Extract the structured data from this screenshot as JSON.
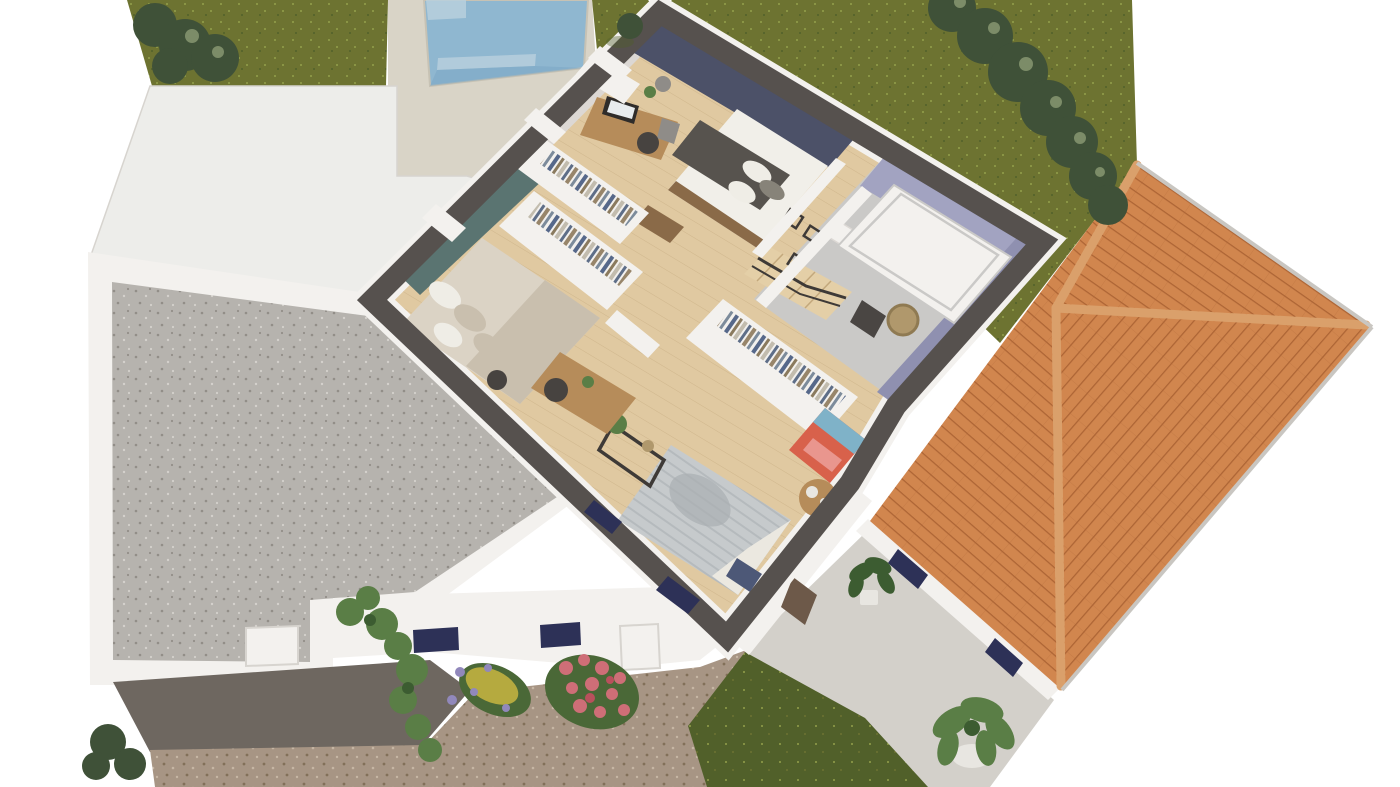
{
  "meta": {
    "view": "3d-floorplan-upper-floor-cutaway",
    "rooms": [
      {
        "name": "master-bedroom",
        "accent": "navy"
      },
      {
        "name": "walk-in-closet",
        "accent": "white"
      },
      {
        "name": "second-bedroom",
        "accent": "teal"
      },
      {
        "name": "third-bedroom",
        "accent": "white"
      },
      {
        "name": "bathroom",
        "accent": "lavender"
      },
      {
        "name": "hallway-stairs",
        "accent": "white"
      }
    ],
    "exterior": [
      "lawn",
      "hedges",
      "swimming-pool",
      "pool-deck",
      "terrace-slab",
      "gravel-courtyard",
      "carport",
      "gravel-driveway",
      "front-facade",
      "climbing-vine",
      "rose-bush",
      "flower-bed",
      "terracotta-roof",
      "patio",
      "potted-plants"
    ]
  },
  "colors": {
    "bg": "#ffffff",
    "grass": "#6d7331",
    "grass_dark": "#51602a",
    "grass_speck": "#93a04b",
    "tree": "#3f5138",
    "tree_light": "#7c8c68",
    "pool_water": "#8fb7d0",
    "pool_water_deep": "#79a6c4",
    "pool_step": "#b9d0dd",
    "deck": "#d9d4c7",
    "deck_line": "#c7c2b4",
    "slab": "#ededea",
    "slab_edge": "#d7d4cf",
    "cut_band": "#56514e",
    "wall_white": "#f3f1ee",
    "wall_shade": "#dcd8d4",
    "navy_wall": "#4c5168",
    "teal_wall": "#5a7471",
    "lavender": "#a2a3c1",
    "lavender_deep": "#8f90b0",
    "bath_floor": "#cac9c7",
    "wood": "#e0c9a1",
    "wood_line": "#c3a87c",
    "roof": "#d1864e",
    "roof_line": "#ad6535",
    "roof_ridge": "#daa06b",
    "gutter": "#c9c6c1",
    "gravel": "#b6b3ae",
    "gravel_dot": "#928e88",
    "gravel_light": "#d4d1cc",
    "driveway": "#a79584",
    "driveway_dot": "#827059",
    "driveway_light": "#c6b6a4",
    "shadow": "#6e6760",
    "terrace": "#d3d0ca",
    "shutter": "#2d3157",
    "passage_door": "#6d5949",
    "duvet": "#57534e",
    "mattress": "#f1efe9",
    "pillow_white": "#efede6",
    "pillow_gray": "#878379",
    "bed_frame": "#8a6a48",
    "cream": "#dbd3c5",
    "cream_deep": "#c9bfae",
    "knit": "#aaafb2",
    "knit_light": "#c6cacc",
    "sheet": "#ebe8e0",
    "pillow_navy": "#4d5877",
    "desk": "#b68c5a",
    "chair": "#474340",
    "metal": "#8f8c88",
    "red_box": "#d8614b",
    "red_light": "#e9968e",
    "blue_box": "#7fb2c8",
    "wicker": "#b0986c",
    "wicker_dark": "#8f7a52",
    "radiator": "#4a4643",
    "plant": "#5a7e46",
    "plant_dark": "#3c5c31",
    "pot": "#e8e6e1",
    "rose": "#ce6e77",
    "rose_deep": "#b9505c",
    "leaf": "#4a6837",
    "yellow_fl": "#b5aa3f",
    "purple_fl": "#9188bb",
    "frame_dark": "#3e3a37",
    "monitor": "#2f2c2a",
    "screen": "#e8ecee",
    "stair_wood": "#e4cfa7",
    "rail": "#3e3a37",
    "clothes1": "#56688a",
    "clothes2": "#8a7a5e",
    "clothes3": "#c2bcae",
    "clothes4": "#5e6e88",
    "clothes5": "#97856a",
    "clothes6": "#7c8b9b"
  }
}
